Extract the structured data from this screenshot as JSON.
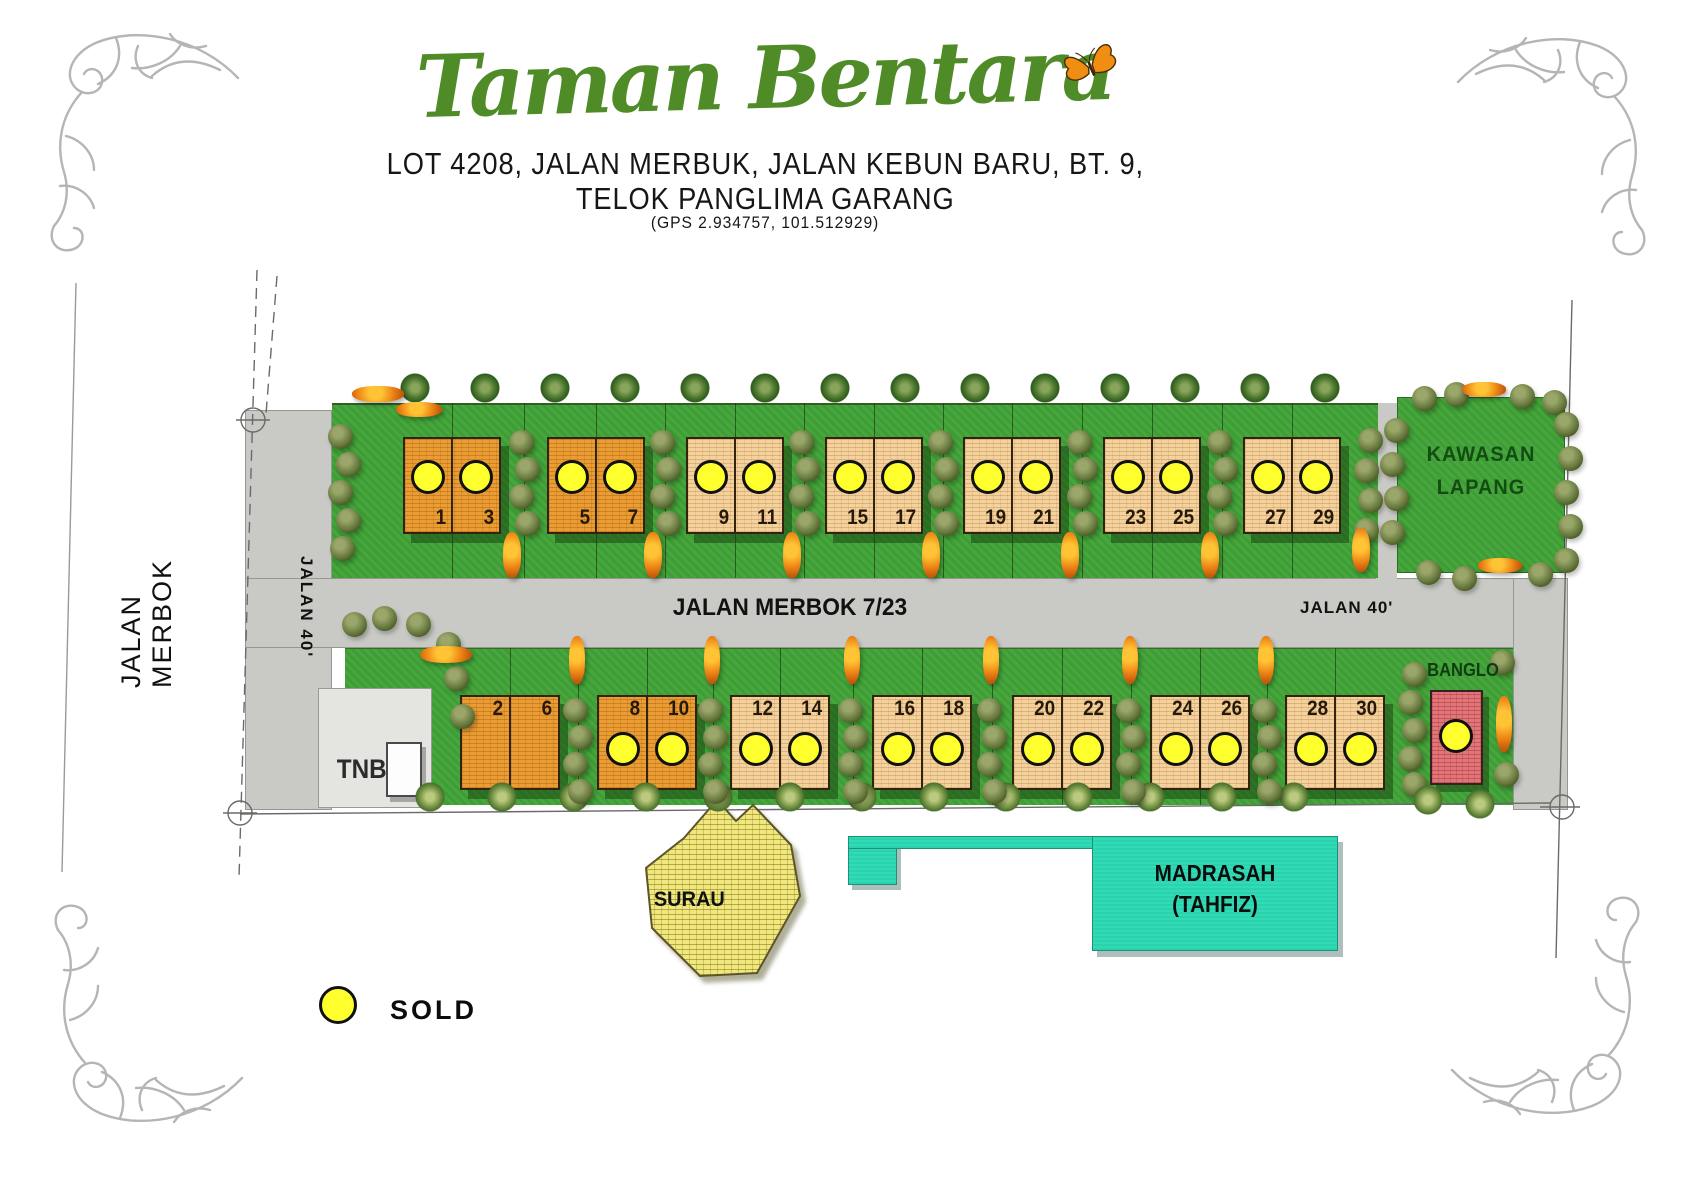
{
  "header": {
    "title": "Taman Bentara",
    "address_line1": "LOT 4208, JALAN MERBUK, JALAN KEBUN BARU, BT. 9,",
    "address_line2": "TELOK PANGLIMA GARANG",
    "gps": "(GPS 2.934757, 101.512929)"
  },
  "roads": {
    "left_name": "JALAN MERBOK",
    "left_width_label": "JALAN 40'",
    "main_name": "JALAN MERBOK 7/23",
    "right_width_label": "JALAN 40'"
  },
  "areas": {
    "open_space_line1": "KAWASAN",
    "open_space_line2": "LAPANG",
    "banglo_label": "BANGLO",
    "tnb_label": "TNB",
    "surau_label": "SURAU",
    "madrasah_line1": "MADRASAH",
    "madrasah_line2": "(TAHFIZ)"
  },
  "legend": {
    "sold_label": "SOLD"
  },
  "colors": {
    "title_green": "#4f8c28",
    "grass": "#41a337",
    "road_gray": "#c9c9c5",
    "sold_yellow": "#ffff2d",
    "lot_dark_orange": "#eb9c33",
    "lot_light_tan": "#f5d29d",
    "banglo_pink": "#e2757a",
    "surau_yellow": "#f0e87f",
    "madrasah_teal": "#30dcb6"
  },
  "lots": {
    "top_row": [
      {
        "left_no": "1",
        "right_no": "3",
        "left_sold": true,
        "right_sold": true,
        "shade": "dark"
      },
      {
        "left_no": "5",
        "right_no": "7",
        "left_sold": true,
        "right_sold": true,
        "shade": "dark"
      },
      {
        "left_no": "9",
        "right_no": "11",
        "left_sold": true,
        "right_sold": true,
        "shade": "light"
      },
      {
        "left_no": "15",
        "right_no": "17",
        "left_sold": true,
        "right_sold": true,
        "shade": "light"
      },
      {
        "left_no": "19",
        "right_no": "21",
        "left_sold": true,
        "right_sold": true,
        "shade": "light"
      },
      {
        "left_no": "23",
        "right_no": "25",
        "left_sold": true,
        "right_sold": true,
        "shade": "light"
      },
      {
        "left_no": "27",
        "right_no": "29",
        "left_sold": true,
        "right_sold": true,
        "shade": "light"
      }
    ],
    "bottom_row": [
      {
        "left_no": "2",
        "right_no": "6",
        "left_sold": false,
        "right_sold": false,
        "shade": "dark"
      },
      {
        "left_no": "8",
        "right_no": "10",
        "left_sold": true,
        "right_sold": true,
        "shade": "dark"
      },
      {
        "left_no": "12",
        "right_no": "14",
        "left_sold": true,
        "right_sold": true,
        "shade": "light"
      },
      {
        "left_no": "16",
        "right_no": "18",
        "left_sold": true,
        "right_sold": true,
        "shade": "light"
      },
      {
        "left_no": "20",
        "right_no": "22",
        "left_sold": true,
        "right_sold": true,
        "shade": "light"
      },
      {
        "left_no": "24",
        "right_no": "26",
        "left_sold": true,
        "right_sold": true,
        "shade": "light"
      },
      {
        "left_no": "28",
        "right_no": "30",
        "left_sold": true,
        "right_sold": true,
        "shade": "light"
      }
    ],
    "banglo": {
      "sold": true
    }
  }
}
